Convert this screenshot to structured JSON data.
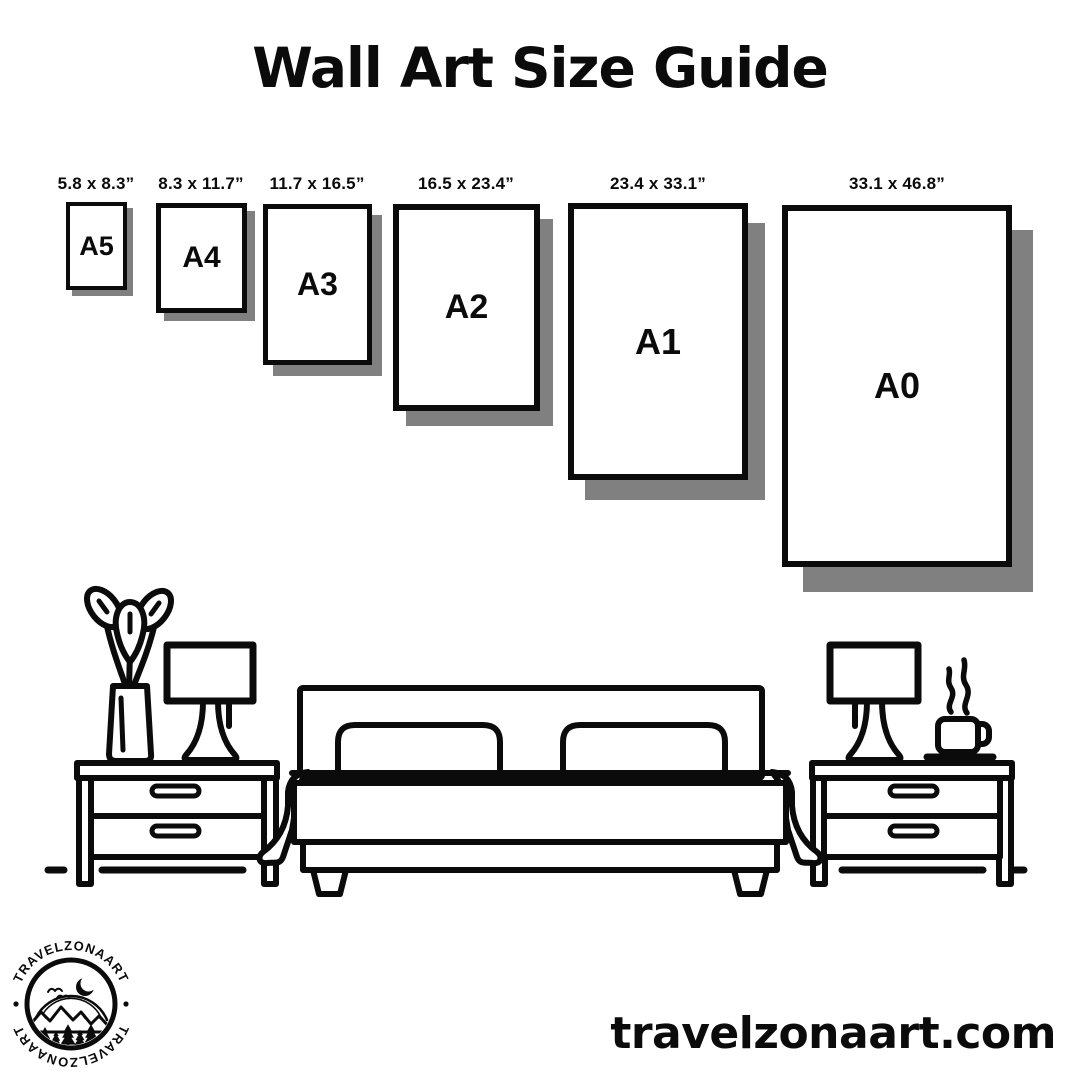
{
  "title": "Wall Art Size Guide",
  "sizes": [
    {
      "name": "A5",
      "dimensions": "5.8 x 8.3”"
    },
    {
      "name": "A4",
      "dimensions": "8.3 x 11.7”"
    },
    {
      "name": "A3",
      "dimensions": "11.7 x 16.5”"
    },
    {
      "name": "A2",
      "dimensions": "16.5 x 23.4”"
    },
    {
      "name": "A1",
      "dimensions": "23.4 x 33.1”"
    },
    {
      "name": "A0",
      "dimensions": "33.1 x 46.8”"
    }
  ],
  "scene_items": [
    "plant-vase",
    "table-lamp-left",
    "nightstand-left",
    "double-bed",
    "nightstand-right",
    "table-lamp-right",
    "steaming-coffee-cup",
    "floor-line"
  ],
  "brand": {
    "logo_text_top": "TRAVELZONAART",
    "logo_text_bottom": "TRAVELZONAART",
    "website": "travelzonaart.com"
  },
  "colors": {
    "ink": "#0b0b0b",
    "paper": "#ffffff",
    "shadow": "#808080"
  }
}
